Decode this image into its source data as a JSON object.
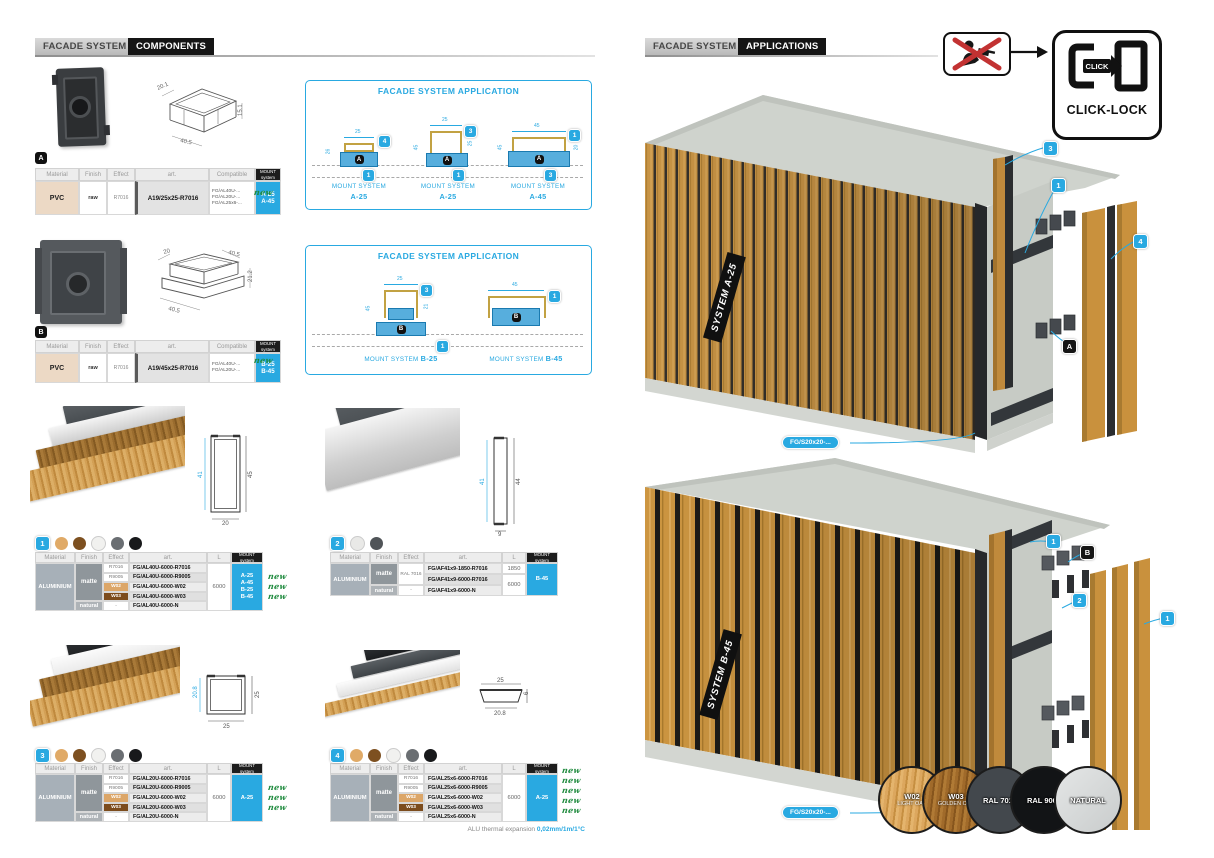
{
  "colors": {
    "accent": "#29a9e1",
    "new_green": "#1e8a3d",
    "wood_light_w02": "#d9a35a",
    "wood_golden_w03": "#8a5a22",
    "ral7016": "#43484d",
    "ral9005": "#121416",
    "natural_silver": "#d9dbdb",
    "concrete": "#cdd1cb"
  },
  "left": {
    "header": {
      "title": "FACADE SYSTEM",
      "section": "COMPONENTS"
    },
    "comp_headers": {
      "material": "Material",
      "finish": "Finish",
      "effect": "Effect",
      "art": "art.",
      "compatible": "Compatible",
      "mount1": "MOUNT",
      "mount2": "system"
    },
    "prof_headers": {
      "material": "Material",
      "finish": "Finish",
      "effect": "Effect",
      "art": "art.",
      "length": "L",
      "mount1": "MOUNT",
      "mount2": "system"
    },
    "component_a": {
      "marker": "A",
      "dims": [
        "20.1",
        "40.5",
        "15.1"
      ],
      "material": "PVC",
      "finish": "raw",
      "effect": "R7016",
      "art": "A19/25x25-R7016",
      "compatible": [
        "FG/AL40U-...",
        "FG/AL20U-...",
        "FG/AL25x6-..."
      ],
      "mounts": [
        "A-25",
        "A-45"
      ],
      "new_label": "new"
    },
    "component_b": {
      "marker": "B",
      "dims": [
        "20",
        "40.5",
        "21.2",
        "40.5"
      ],
      "material": "PVC",
      "finish": "raw",
      "effect": "R7016",
      "art": "A19/45x25-R7016",
      "compatible": [
        "FG/AL40U-...",
        "FG/AL20U-..."
      ],
      "mounts": [
        "B-25",
        "B-45"
      ],
      "new_label": "new"
    },
    "app1": {
      "title": "FACADE SYSTEM APPLICATION",
      "diagrams": [
        {
          "name": "MOUNT SYSTEM",
          "system": "A-25",
          "marker": "A",
          "badge_top": "4",
          "badge_bottom": "1",
          "dim_top": "25",
          "dim_left": "26",
          "dim_right": "6"
        },
        {
          "name": "MOUNT SYSTEM",
          "system": "A-25",
          "marker": "A",
          "badge_top": "3",
          "badge_bottom": "1",
          "dim_top": "25",
          "dim_left": "45",
          "dim_right": "25"
        },
        {
          "name": "MOUNT SYSTEM",
          "system": "A-45",
          "marker": "A",
          "badge_top": "1",
          "badge_bottom": "3",
          "dim_top": "45",
          "dim_left": "45",
          "dim_right": "20"
        }
      ]
    },
    "app2": {
      "title": "FACADE SYSTEM APPLICATION",
      "shared_badge": "1",
      "diagrams": [
        {
          "name": "MOUNT SYSTEM",
          "system": "B-25",
          "marker": "B",
          "badge_top": "3",
          "dim_top": "25",
          "dim_left": "45",
          "dim_right": "21"
        },
        {
          "name": "MOUNT SYSTEM",
          "system": "B-45",
          "marker": "B",
          "badge_top": "1",
          "dim_top": "45"
        }
      ]
    },
    "profile1": {
      "badge": "1",
      "dims": [
        "41",
        "45",
        "20"
      ],
      "material": "ALUMINIUM",
      "length": "6000",
      "mounts": [
        "A-25",
        "A-45",
        "B-25",
        "B-45"
      ],
      "rows": [
        {
          "finish": "matte",
          "effect": "R7016",
          "art": "FG/AL40U-6000-R7016",
          "new": ""
        },
        {
          "effect": "R9005",
          "art": "FG/AL40U-6000-R9005",
          "new": "new"
        },
        {
          "effect": "W02",
          "art": "FG/AL40U-6000-W02",
          "new": "new"
        },
        {
          "effect": "W03",
          "art": "FG/AL40U-6000-W03",
          "new": "new"
        },
        {
          "finish": "natural",
          "effect": "-",
          "art": "FG/AL40U-6000-N",
          "new": ""
        }
      ]
    },
    "profile2": {
      "badge": "2",
      "dims": [
        "41",
        "44",
        "9"
      ],
      "material": "ALUMINIUM",
      "mounts": [
        "B-45"
      ],
      "rows": [
        {
          "finish": "matte",
          "effect": "RAL 7016",
          "art": "FG/AF41x9-1850-R7016",
          "length": "1850"
        },
        {
          "effect": "",
          "art": "FG/AF41x9-6000-R7016",
          "length": "6000"
        },
        {
          "finish": "natural",
          "effect": "-",
          "art": "FG/AF41x9-6000-N",
          "length": ""
        }
      ]
    },
    "profile3": {
      "badge": "3",
      "dims": [
        "20.8",
        "25",
        "25"
      ],
      "material": "ALUMINIUM",
      "length": "6000",
      "mounts": [
        "A-25"
      ],
      "rows": [
        {
          "finish": "matte",
          "effect": "R7016",
          "art": "FG/AL20U-6000-R7016",
          "new": ""
        },
        {
          "effect": "R9005",
          "art": "FG/AL20U-6000-R9005",
          "new": "new"
        },
        {
          "effect": "W02",
          "art": "FG/AL20U-6000-W02",
          "new": "new"
        },
        {
          "effect": "W03",
          "art": "FG/AL20U-6000-W03",
          "new": "new"
        },
        {
          "finish": "natural",
          "effect": "-",
          "art": "FG/AL20U-6000-N",
          "new": ""
        }
      ]
    },
    "profile4": {
      "badge": "4",
      "dims": [
        "25",
        "20.8",
        "6"
      ],
      "material": "ALUMINIUM",
      "length": "6000",
      "mounts": [
        "A-25"
      ],
      "rows": [
        {
          "finish": "matte",
          "effect": "R7016",
          "art": "FG/AL25x6-6000-R7016",
          "new": "new"
        },
        {
          "effect": "R9005",
          "art": "FG/AL25x6-6000-R9005",
          "new": "new"
        },
        {
          "effect": "W02",
          "art": "FG/AL25x6-6000-W02",
          "new": "new"
        },
        {
          "effect": "W03",
          "art": "FG/AL25x6-6000-W03",
          "new": "new"
        },
        {
          "finish": "natural",
          "effect": "-",
          "art": "FG/AL25x6-6000-N",
          "new": "new"
        }
      ]
    },
    "footnote": {
      "label": "ALU thermal expansion",
      "value": "0,02mm/1m/1°C"
    }
  },
  "right": {
    "header": {
      "title": "FACADE SYSTEM",
      "section": "APPLICATIONS"
    },
    "clicklock": {
      "click": "CLICK",
      "label": "CLICK-LOCK"
    },
    "render_a": {
      "label": "SYSTEM A-25",
      "callout": "FG/S20x20-...",
      "badges": [
        "3",
        "1",
        "4",
        "A"
      ]
    },
    "render_b": {
      "label": "SYSTEM B-45",
      "callout": "FG/S20x20-...",
      "badges": [
        "1",
        "B",
        "2",
        "1"
      ]
    },
    "swatches": [
      {
        "code": "W02",
        "name": "LIGHT OAK"
      },
      {
        "code": "W03",
        "name": "GOLDEN OAK"
      },
      {
        "code": "RAL 7016",
        "name": ""
      },
      {
        "code": "RAL 9005",
        "name": ""
      },
      {
        "code": "NATURAL",
        "name": ""
      }
    ]
  }
}
